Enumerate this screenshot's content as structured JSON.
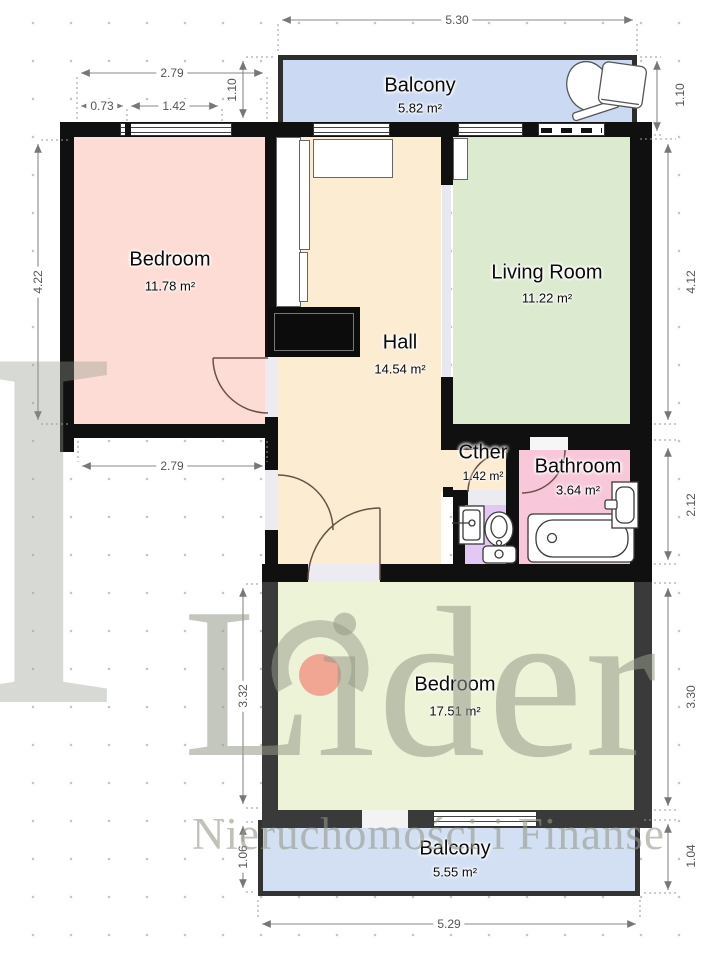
{
  "rooms": {
    "balcony_top": {
      "name": "Balcony",
      "area": "5.82 m²",
      "color": "#ccd9f2"
    },
    "bedroom_left": {
      "name": "Bedroom",
      "area": "11.78 m²",
      "color": "#fcdcd4"
    },
    "living_room": {
      "name": "Living Room",
      "area": "11.22 m²",
      "color": "#dcead0"
    },
    "hall": {
      "name": "Hall",
      "area": "14.54 m²",
      "color": "#fcecd2"
    },
    "other": {
      "name": "Cther",
      "area": "1.42 m²",
      "color": "#e4c8f4"
    },
    "bathroom": {
      "name": "Bathroom",
      "area": "3.64 m²",
      "color": "#f8c8da"
    },
    "bedroom_bottom": {
      "name": "Bedroom",
      "area": "17.51 m²",
      "color": "#edf3d7"
    },
    "balcony_bottom": {
      "name": "Balcony",
      "area": "5.55 m²",
      "color": "#d3e0f4"
    }
  },
  "dimensions": {
    "top_width": "5.30",
    "bedroom_top_width": "2.79",
    "bedroom_window_left": "0.73",
    "bedroom_window_right": "1.42",
    "balcony_top_left_height": "1.10",
    "balcony_top_right_height": "1.10",
    "bedroom_left_height": "4.22",
    "living_room_height": "4.12",
    "bedroom_bottom_width": "2.79",
    "bathroom_height": "2.12",
    "bedroom_bottom_left_height": "3.32",
    "bedroom_bottom_right_height": "3.30",
    "balcony_bottom_left_height": "1.06",
    "balcony_bottom_right_height": "1.04",
    "bottom_width": "5.29"
  },
  "watermark": {
    "brand": "Lider",
    "tagline": "Nieruchomości i Finanse",
    "partial_letter": "I",
    "text_color": "#949989",
    "dot_color": "#f0a18e"
  },
  "wall_colors": {
    "main": "#101010",
    "secondary": "#3a3a3a"
  }
}
